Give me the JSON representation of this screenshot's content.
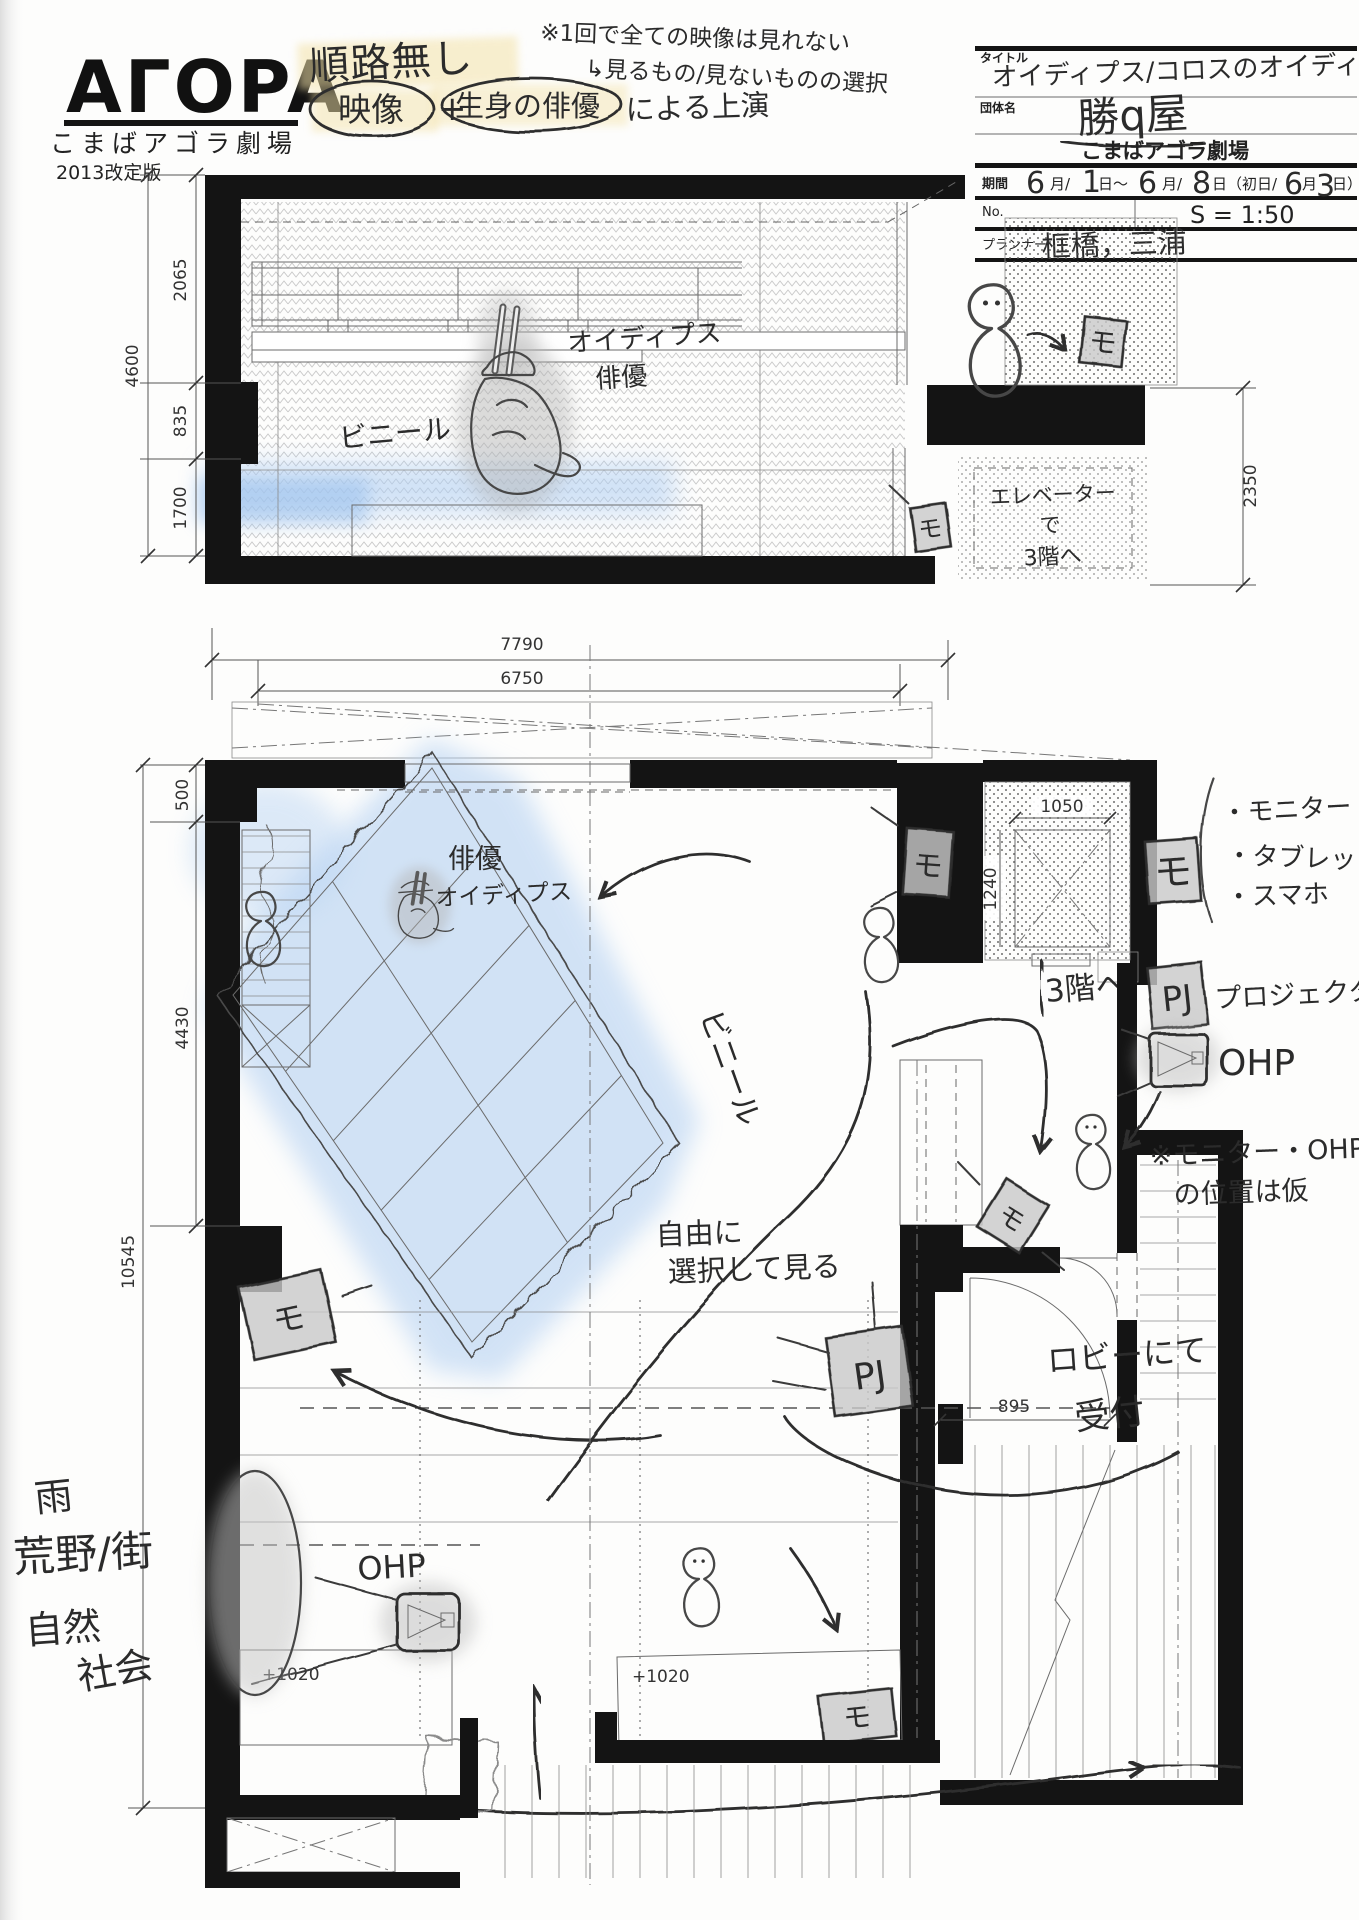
{
  "branding": {
    "logo": "AΓOPA",
    "theater": "こまばアゴラ劇場",
    "edition": "2013改定版"
  },
  "top_notes": {
    "route": "順路無し",
    "video": "映像",
    "plus": "+",
    "live_actor": "生身の俳優",
    "by_performance": "による上演",
    "caution1": "※1回で全ての映像は見れない",
    "caution2": "↳見るもの/見ないものの選択"
  },
  "title_block": {
    "title_label": "タイトル",
    "title": "オイディプス/コロスのオイディプス",
    "org_label": "団体名",
    "org": "勝q屋",
    "venue": "こまばアゴラ劇場",
    "period_label": "期間",
    "period": {
      "m1": "6",
      "u1": "月/",
      "d1": "1",
      "u2": "日～",
      "m2": "6",
      "u3": "月/",
      "d2": "8",
      "u4": "日（初日/",
      "fm": "6",
      "u5": "月",
      "fd": "3",
      "u6": "日）"
    },
    "no_label": "No.",
    "scale": "S = 1:50",
    "planner_label": "プランナー",
    "planner": "框橋，三浦"
  },
  "section": {
    "vinyl": "ビニール",
    "actor_line1": "オイディプス",
    "actor_line2": "俳優",
    "elevator_line1": "エレベーター",
    "elevator_line2": "で",
    "elevator_line3": "3階へ",
    "monitor": "モ",
    "dims": {
      "h_upper": "2065",
      "h_mid": "835",
      "h_lower": "1700",
      "h_total": "4600",
      "right": "2350",
      "w_outer": "7790",
      "w_inner": "6750"
    }
  },
  "plan": {
    "actor_line1": "俳優",
    "actor_line2": "オイディプス",
    "vinyl": "ビニール",
    "free_line1": "自由に",
    "free_line2": "選択して見る",
    "to_3f": "3階へ",
    "monitor": "モ",
    "projector": "PJ",
    "ohp": "OHP",
    "reception_line1": "ロビーにて",
    "reception_line2": "受付",
    "dims": {
      "top": "500",
      "left_mid": "4430",
      "left_total": "10545",
      "elev_w": "1050",
      "elev_d": "1240",
      "door": "895",
      "platform_a": "+1020",
      "platform_b": "+1020"
    }
  },
  "legend": {
    "mo_symbol": "モ",
    "mo_items": [
      "・モニター",
      "・タブレット",
      "・スマホ"
    ],
    "pj_symbol": "PJ",
    "pj_label": "プロジェクター",
    "ohp_label": "OHP",
    "note_line1": "※モニター・OHP",
    "note_line2": "の位置は仮"
  },
  "margin_notes": [
    "雨",
    "荒野/街",
    "自然",
    "社会"
  ]
}
